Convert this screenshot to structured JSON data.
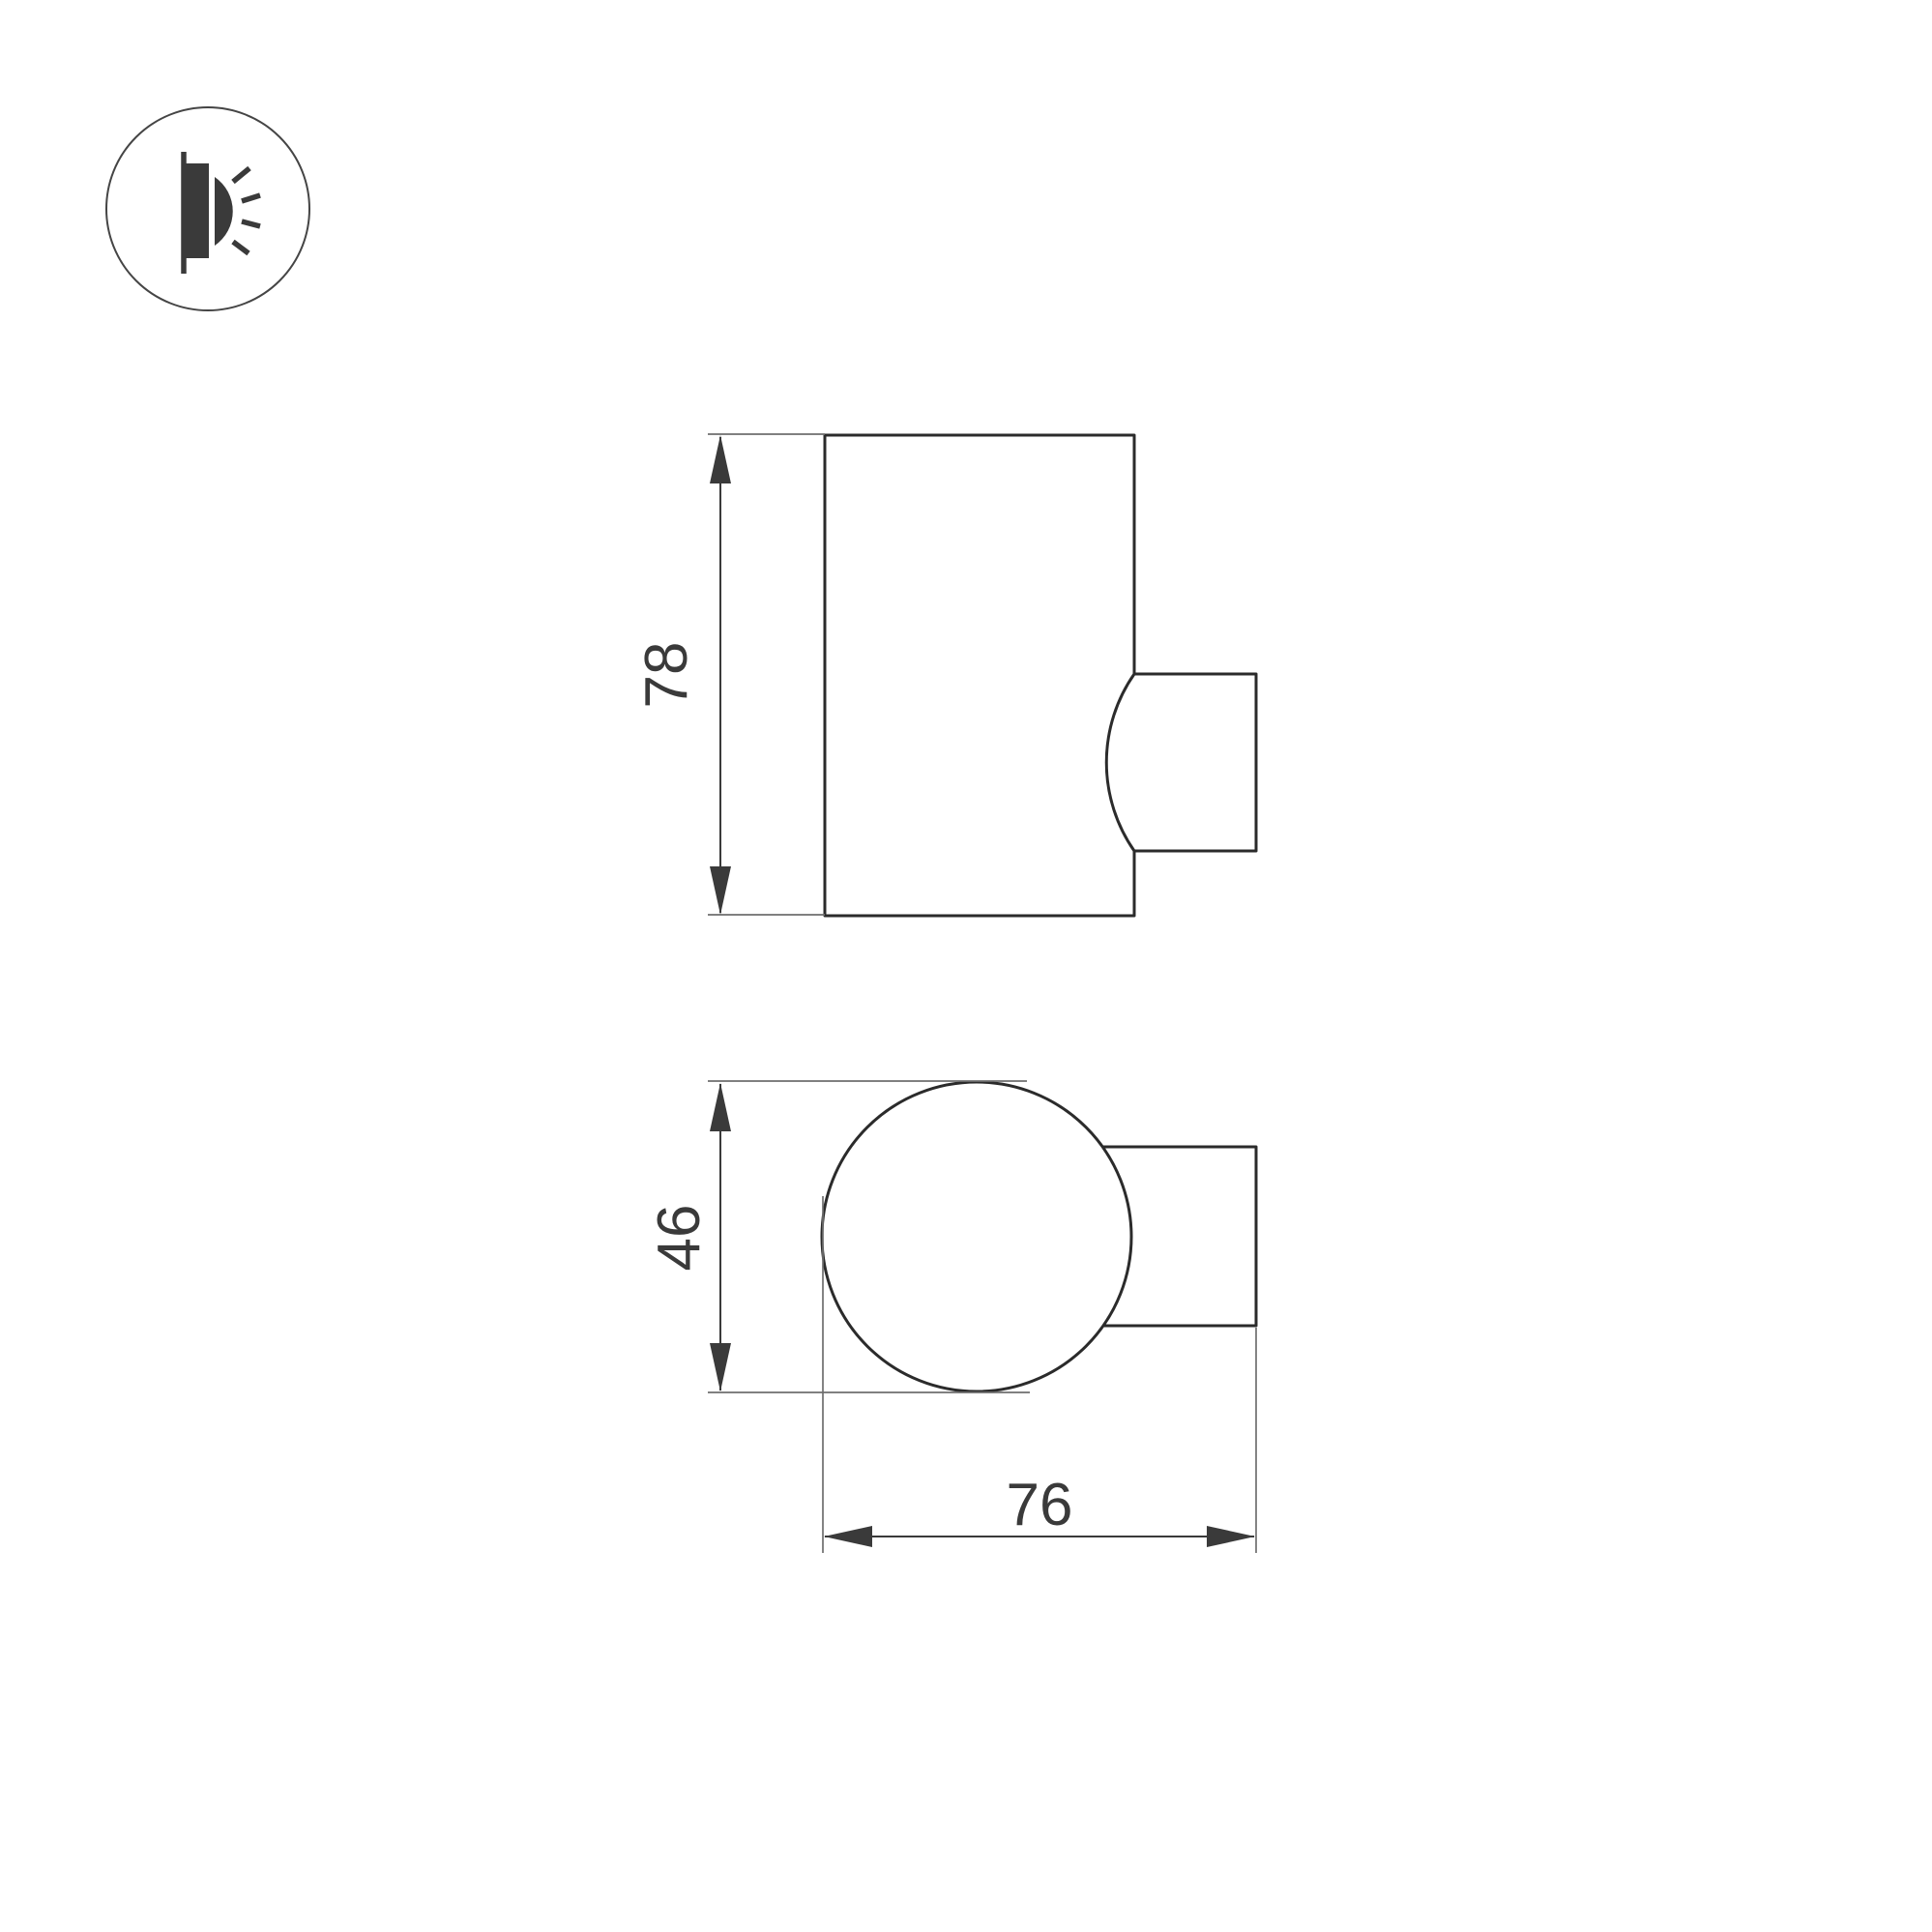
{
  "page": {
    "background": "#ffffff"
  },
  "icon": {
    "name": "wall-lamp-side-glow-icon"
  },
  "views": {
    "side_view": {
      "height_label": "78"
    },
    "top_view": {
      "depth_label": "46",
      "width_label": "76"
    }
  },
  "colors": {
    "outline": "#2b2b2b",
    "dimension": "#3a3a3a",
    "extension": "#6e6e6e",
    "text": "#3a3a3a",
    "icon": "#3a3a3a",
    "background": "#ffffff"
  }
}
